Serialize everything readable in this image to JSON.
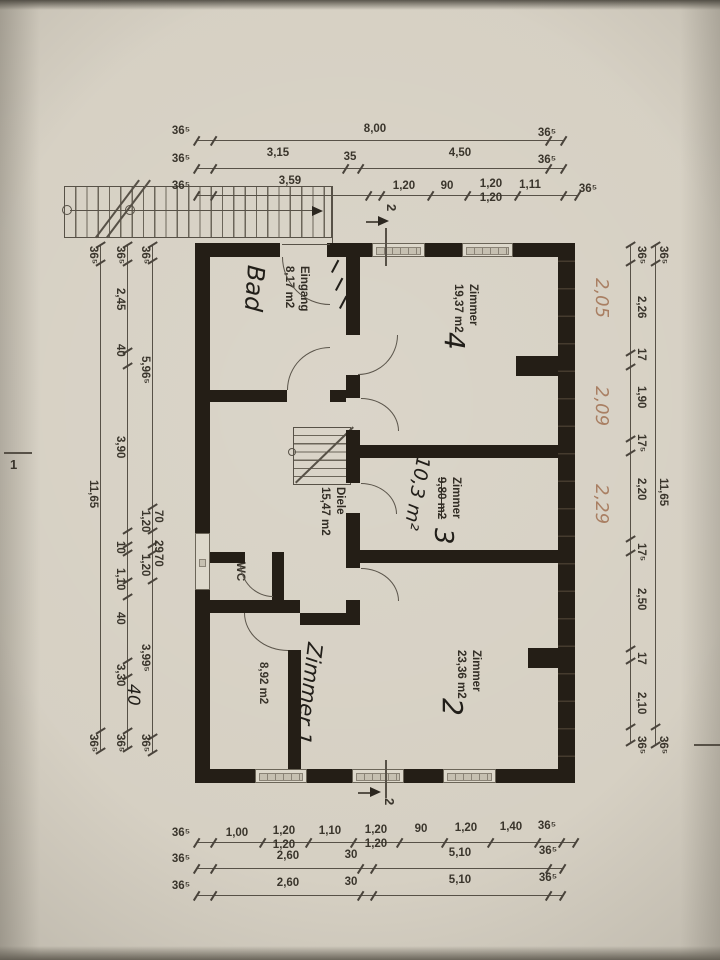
{
  "rooms": {
    "eingang_bad": {
      "printed_name": "Eingang",
      "printed_area": "8,17 m2",
      "handwritten_name": "Bad"
    },
    "zimmer4": {
      "printed_name": "Zimmer",
      "handwritten_number": "4",
      "printed_area": "19,37 m2"
    },
    "diele": {
      "printed_name": "Diele",
      "printed_area": "15,47 m2"
    },
    "zimmer3": {
      "printed_name": "Zimmer",
      "handwritten_number": "3",
      "printed_area_struck": "9,80 m2",
      "handwritten_area": "10,3 m²"
    },
    "wc": {
      "printed_name": "WC"
    },
    "zimmer1_kueche": {
      "printed_name_struck": "Küche",
      "handwritten_name": "Zimmer 1",
      "printed_area": "8,92 m2"
    },
    "zimmer2": {
      "printed_name": "Zimmer",
      "handwritten_number": "2",
      "printed_area": "23,36 m2"
    }
  },
  "markers": {
    "section_top": "2",
    "section_bottom": "2",
    "section_left": "1"
  },
  "dims": {
    "top": [
      [
        "36⁵",
        "8,00",
        "36⁵"
      ],
      [
        "36⁵",
        "3,15",
        "35",
        "4,50",
        "36⁵"
      ],
      [
        "36⁵",
        "3,59",
        "1,20",
        "90",
        "1,20",
        "1,20",
        "1,11",
        "36⁵"
      ]
    ],
    "bottom": [
      [
        "36⁵",
        "1,00",
        "1,20",
        "1,20",
        "1,10",
        "1,20",
        "1,20",
        "90",
        "1,20",
        "1,40",
        "36⁵"
      ],
      [
        "36⁵",
        "2,60",
        "30",
        "5,10",
        "36⁵"
      ],
      [
        "36⁵",
        "2,60",
        "30",
        "5,10",
        "36⁵"
      ]
    ],
    "left": {
      "inner": [
        "36⁵",
        "5,96⁵",
        "70",
        "1,20",
        "29",
        "70",
        "1,20",
        "3,99⁵",
        "36⁵"
      ],
      "middle": [
        "36⁵",
        "2,45",
        "40",
        "3,90",
        "10",
        "1,10",
        "40",
        "3,30",
        "36⁵"
      ],
      "outer": [
        "36⁵",
        "11,65",
        "36⁵"
      ],
      "hand": [
        "40"
      ]
    },
    "right": {
      "inner": [
        "36⁵",
        "2,26",
        "17",
        "1,90",
        "17⁵",
        "2,20",
        "17⁵",
        "2,50",
        "17",
        "2,10",
        "36⁵"
      ],
      "outer": [
        "36⁵",
        "11,65",
        "36⁵"
      ],
      "hand": [
        "2,05",
        "2,09",
        "2,29"
      ]
    }
  }
}
